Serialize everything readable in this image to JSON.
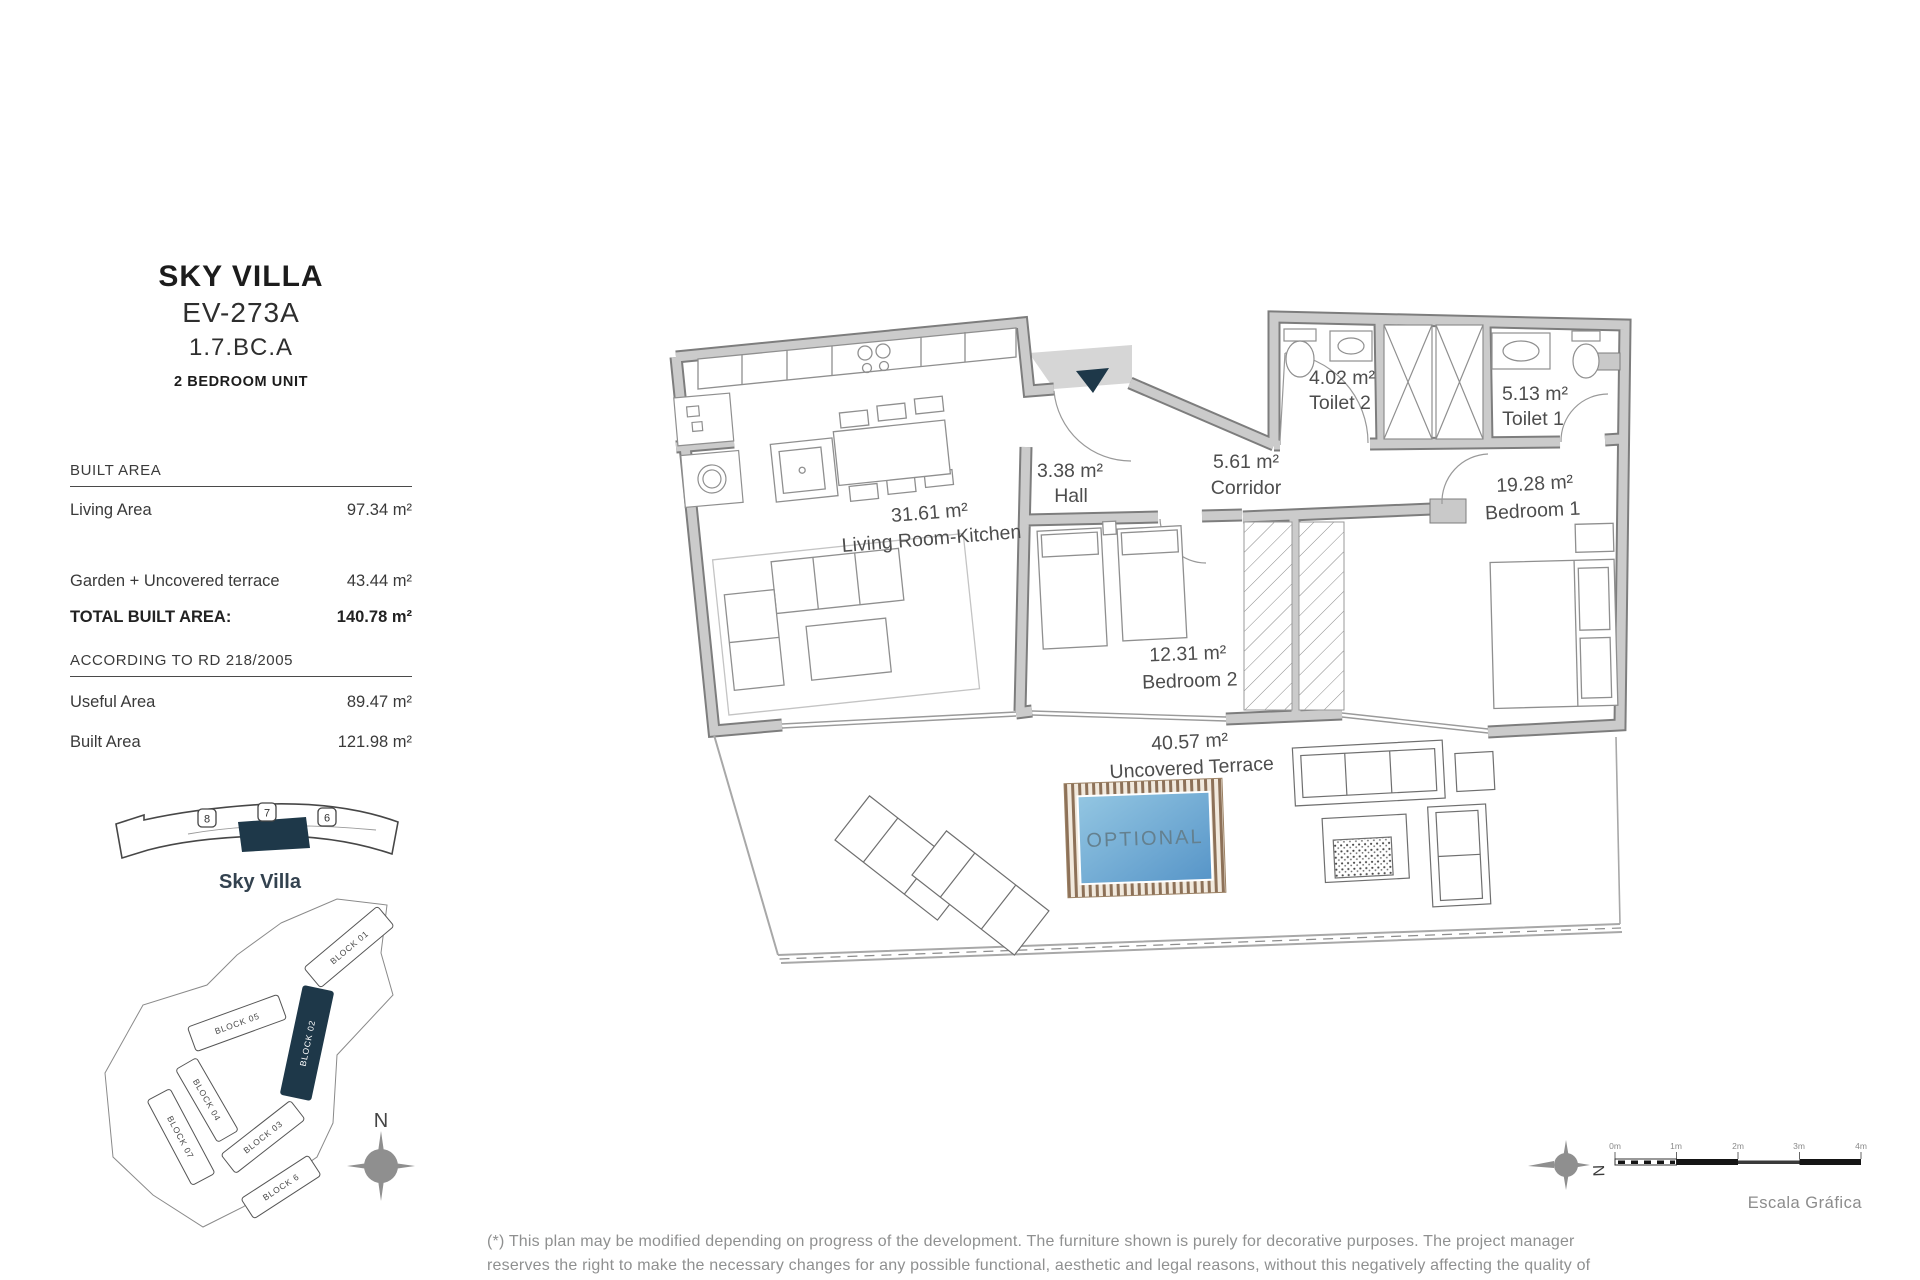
{
  "header": {
    "title": "SKY VILLA",
    "code": "EV-273A",
    "ref": "1.7.BC.A",
    "unit_type": "2 BEDROOM UNIT"
  },
  "built": {
    "heading": "BUILT AREA",
    "rows": [
      {
        "label": "Living Area",
        "value": "97.34 m²"
      },
      {
        "label": "Garden + Uncovered terrace",
        "value": "43.44 m²"
      }
    ],
    "total_label": "TOTAL BUILT AREA:",
    "total_value": "140.78 m²"
  },
  "rd": {
    "heading": "ACCORDING TO RD 218/2005",
    "rows": [
      {
        "label": "Useful Area",
        "value": "89.47 m²"
      },
      {
        "label": "Built Area",
        "value": "121.98 m²"
      }
    ]
  },
  "locator": {
    "badges": [
      "8",
      "7",
      "6"
    ],
    "name": "Sky Villa"
  },
  "site": {
    "blocks": {
      "b01": "BLOCK 01",
      "b02": "BLOCK 02",
      "b05": "BLOCK 05",
      "b04": "BLOCK 04",
      "b03": "BLOCK 03",
      "b06": "BLOCK 6",
      "b07": "BLOCK 07"
    },
    "north": "N"
  },
  "plan": {
    "rooms": {
      "living": {
        "area": "31.61 m²",
        "name": "Living Room-Kitchen"
      },
      "hall": {
        "area": "3.38 m²",
        "name": "Hall"
      },
      "corridor": {
        "area": "5.61 m²",
        "name": "Corridor"
      },
      "toilet2": {
        "area": "4.02 m²",
        "name": "Toilet 2"
      },
      "toilet1": {
        "area": "5.13 m²",
        "name": "Toilet 1"
      },
      "bedroom1": {
        "area": "19.28 m²",
        "name": "Bedroom 1"
      },
      "bedroom2": {
        "area": "12.31 m²",
        "name": "Bedroom 2"
      },
      "terrace": {
        "area": "40.57 m²",
        "name": "Uncovered Terrace"
      }
    },
    "optional": "OPTIONAL"
  },
  "scale": {
    "north": "N",
    "ticks": [
      "0m",
      "1m",
      "2m",
      "3m",
      "4m"
    ],
    "caption": "Escala Gráfica"
  },
  "footer": {
    "disclaimer": "(*) This plan may be modified depending on progress of the development. The furniture shown is purely for decorative purposes. The project manager reserves the right to make the necessary changes for any possible functional, aesthetic and legal reasons, without this negatively affecting the quality of the construction. Illustrative dimensions."
  },
  "colors": {
    "accent_navy": "#1e3849",
    "wall_gray": "#cbcbcb",
    "pool_blue": "#5e9fd0"
  }
}
